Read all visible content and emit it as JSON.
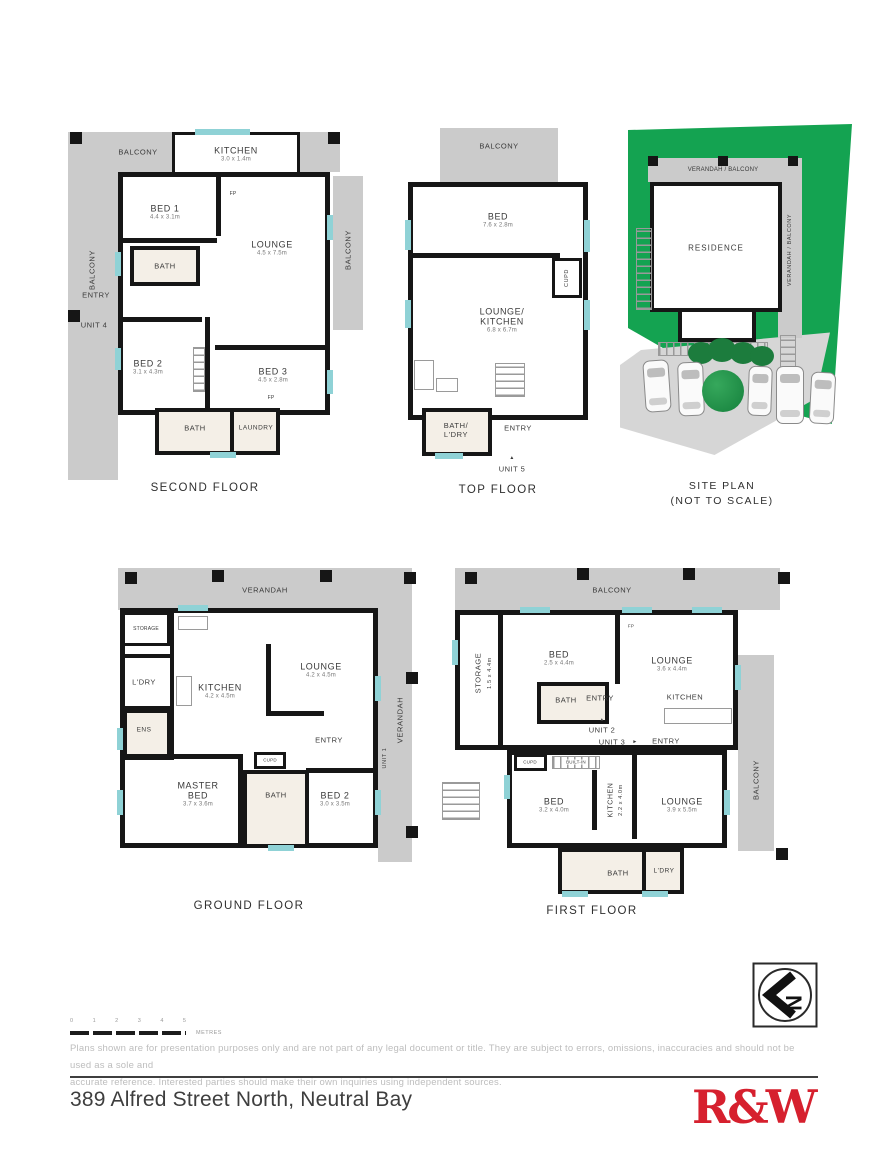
{
  "icons": {
    "up_arrow": "▲",
    "right_arrow": "►",
    "compass_letter": "N"
  },
  "footer": {
    "scale_ticks": [
      "0",
      "1",
      "2",
      "3",
      "4",
      "5"
    ],
    "scale_unit": "METRES",
    "disclaimer_line1": "Plans shown are for presentation purposes only and are not part of any legal document or title. They are subject to errors, omissions, inaccuracies and should not be used as a sole and",
    "disclaimer_line2": "accurate reference. Interested parties should make their own inquiries using independent sources.",
    "address": "389 Alfred Street North, Neutral Bay",
    "brand": "R&W"
  },
  "second_floor": {
    "title": "SECOND FLOOR",
    "balcony_top": "BALCONY",
    "balcony_left": "BALCONY",
    "balcony_right": "BALCONY",
    "kitchen": "KITCHEN",
    "kitchen_dim": "3.0 x 1.4m",
    "fp1": "FP",
    "bed1": "BED 1",
    "bed1_dim": "4.4 x 3.1m",
    "lounge": "LOUNGE",
    "lounge_dim": "4.5 x 7.5m",
    "bath1": "BATH",
    "entry": "ENTRY",
    "unit": "UNIT 4",
    "bed2": "BED 2",
    "bed2_dim": "3.1 x 4.3m",
    "bed3": "BED 3",
    "bed3_dim": "4.5 x 2.8m",
    "fp2": "FP",
    "bath2": "BATH",
    "laundry": "LAUNDRY"
  },
  "top_floor": {
    "title": "TOP FLOOR",
    "balcony": "BALCONY",
    "bed": "BED",
    "bed_dim": "7.6 x 2.8m",
    "cupd": "CUPD",
    "lk1": "LOUNGE/",
    "lk2": "KITCHEN",
    "lk_dim": "6.8 x 6.7m",
    "bl1": "BATH/",
    "bl2": "L'DRY",
    "entry": "ENTRY",
    "unit": "UNIT 5"
  },
  "site_plan": {
    "title1": "SITE PLAN",
    "title2": "(NOT TO SCALE)",
    "verandah_top": "VERANDAH / BALCONY",
    "verandah_right": "VERANDAH / BALCONY",
    "residence": "RESIDENCE"
  },
  "ground_floor": {
    "title": "GROUND FLOOR",
    "verandah_top": "VERANDAH",
    "verandah_right": "VERANDAH",
    "unit": "UNIT 1",
    "storage": "STORAGE",
    "ldry": "L'DRY",
    "ens": "ENS",
    "kitchen": "KITCHEN",
    "kitchen_dim": "4.2 x 4.5m",
    "lounge": "LOUNGE",
    "lounge_dim": "4.2 x 4.5m",
    "entry": "ENTRY",
    "master1": "MASTER",
    "master2": "BED",
    "master_dim": "3.7 x 3.6m",
    "cupd": "CUPD",
    "bath": "BATH",
    "bed2": "BED 2",
    "bed2_dim": "3.0 x 3.5m"
  },
  "first_floor": {
    "title": "FIRST FLOOR",
    "balcony_top": "BALCONY",
    "balcony_right": "BALCONY",
    "storage": "STORAGE",
    "storage_dim": "1.5 x 4.4m",
    "bed_u": "BED",
    "bed_u_dim": "2.5 x 4.4m",
    "lounge_u": "LOUNGE",
    "lounge_u_dim": "3.6 x 4.4m",
    "fp": "FP",
    "bath_u": "BATH",
    "entry_u": "ENTRY",
    "kitchen_u": "KITCHEN",
    "unit2": "UNIT 2",
    "unit3": "UNIT 3",
    "entry_m": "ENTRY",
    "cupd": "CUPD",
    "builtin": "BUILT-IN",
    "bed_l": "BED",
    "bed_l_dim": "3.2 x 4.0m",
    "kitchen_l": "KITCHEN",
    "kitchen_l_dim": "2.2 x 4.0m",
    "lounge_l": "LOUNGE",
    "lounge_l_dim": "3.9 x 5.5m",
    "bath_l": "BATH",
    "ldry": "L'DRY"
  }
}
